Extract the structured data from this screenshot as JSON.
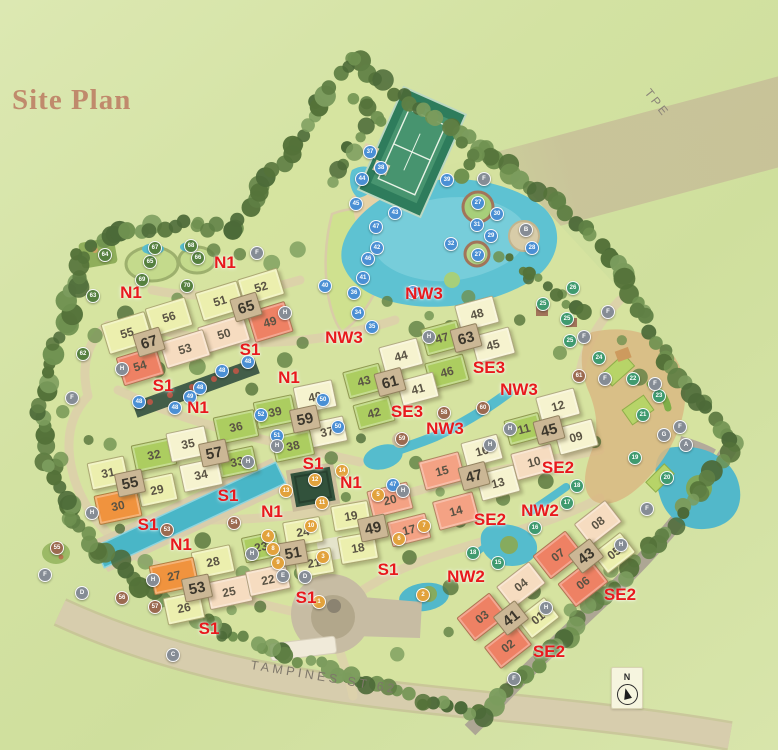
{
  "title": {
    "text": "Site Plan",
    "color": "#c08a6c"
  },
  "roads": {
    "tpe": "TPE",
    "tampines": "TAMPINES ST 62"
  },
  "compass": {
    "label": "N"
  },
  "colors": {
    "label_red": "#e8191d",
    "wing": {
      "lime": "#ecefae",
      "cream": "#f6f3cf",
      "green": "#accd60",
      "peach": "#f6dcc0",
      "salmon": "#f4a284",
      "coral": "#ee8164",
      "orange": "#f0933e"
    },
    "marker": {
      "b": "#4a8fd4",
      "g": "#3f9a6f",
      "o": "#e2a23c",
      "n": "#9b6a50",
      "f": "#55803f",
      "y": "#858c95"
    }
  },
  "unit_labels": [
    [
      "N1",
      131,
      293
    ],
    [
      "N1",
      225,
      263
    ],
    [
      "N1",
      198,
      408
    ],
    [
      "N1",
      289,
      378
    ],
    [
      "N1",
      351,
      483
    ],
    [
      "N1",
      272,
      512
    ],
    [
      "N1",
      181,
      545
    ],
    [
      "S1",
      250,
      350
    ],
    [
      "S1",
      163,
      386
    ],
    [
      "S1",
      228,
      496
    ],
    [
      "S1",
      148,
      525
    ],
    [
      "S1",
      313,
      464
    ],
    [
      "S1",
      388,
      570
    ],
    [
      "S1",
      306,
      598
    ],
    [
      "S1",
      209,
      629
    ],
    [
      "NW3",
      424,
      294
    ],
    [
      "NW3",
      344,
      338
    ],
    [
      "NW3",
      519,
      390
    ],
    [
      "NW3",
      445,
      429
    ],
    [
      "SE3",
      489,
      368
    ],
    [
      "SE3",
      407,
      412
    ],
    [
      "SE2",
      558,
      468
    ],
    [
      "SE2",
      490,
      520
    ],
    [
      "SE2",
      620,
      595
    ],
    [
      "SE2",
      549,
      652
    ],
    [
      "NW2",
      540,
      511
    ],
    [
      "NW2",
      466,
      577
    ]
  ],
  "towers": [
    [
      67,
      148,
      341,
      -17
    ],
    [
      65,
      245,
      306,
      -17
    ],
    [
      55,
      129,
      482,
      -12
    ],
    [
      57,
      213,
      452,
      -12
    ],
    [
      59,
      304,
      418,
      -12
    ],
    [
      61,
      389,
      381,
      -15
    ],
    [
      63,
      465,
      337,
      -15
    ],
    [
      45,
      548,
      429,
      -15
    ],
    [
      47,
      473,
      475,
      -15
    ],
    [
      49,
      372,
      527,
      -12
    ],
    [
      51,
      292,
      552,
      -10
    ],
    [
      53,
      196,
      587,
      -12
    ],
    [
      41,
      510,
      617,
      -38
    ],
    [
      43,
      585,
      555,
      -38
    ]
  ],
  "wings": [
    [
      "55",
      126,
      332,
      44,
      30,
      -17,
      "lime"
    ],
    [
      "56",
      168,
      316,
      40,
      28,
      -17,
      "lime"
    ],
    [
      "51",
      219,
      300,
      42,
      28,
      -17,
      "lime"
    ],
    [
      "52",
      260,
      286,
      40,
      26,
      -17,
      "lime"
    ],
    [
      "50",
      223,
      333,
      46,
      26,
      -17,
      "peach"
    ],
    [
      "53",
      184,
      348,
      44,
      26,
      -17,
      "peach"
    ],
    [
      "49",
      269,
      321,
      38,
      30,
      -17,
      "coral"
    ],
    [
      "54",
      139,
      365,
      40,
      28,
      -17,
      "coral"
    ],
    [
      "31",
      107,
      472,
      36,
      26,
      -12,
      "lime"
    ],
    [
      "32",
      153,
      454,
      40,
      26,
      -12,
      "green"
    ],
    [
      "35",
      187,
      443,
      38,
      28,
      -12,
      "cream"
    ],
    [
      "36",
      235,
      426,
      40,
      26,
      -12,
      "green"
    ],
    [
      "39",
      274,
      411,
      38,
      26,
      -12,
      "green"
    ],
    [
      "40",
      314,
      396,
      38,
      26,
      -12,
      "cream"
    ],
    [
      "37",
      326,
      431,
      36,
      24,
      -12,
      "cream"
    ],
    [
      "38",
      292,
      445,
      38,
      24,
      -12,
      "green"
    ],
    [
      "33",
      236,
      461,
      36,
      24,
      -12,
      "green"
    ],
    [
      "34",
      200,
      474,
      38,
      26,
      -12,
      "cream"
    ],
    [
      "29",
      156,
      489,
      36,
      26,
      -12,
      "lime"
    ],
    [
      "30",
      117,
      505,
      42,
      28,
      -12,
      "orange"
    ],
    [
      "28",
      212,
      561,
      38,
      26,
      -12,
      "lime"
    ],
    [
      "27",
      173,
      575,
      44,
      28,
      -12,
      "orange"
    ],
    [
      "26",
      183,
      607,
      36,
      26,
      -12,
      "lime"
    ],
    [
      "25",
      228,
      591,
      42,
      26,
      -12,
      "peach"
    ],
    [
      "22",
      267,
      579,
      40,
      24,
      -12,
      "peach"
    ],
    [
      "23",
      260,
      546,
      34,
      24,
      -12,
      "green"
    ],
    [
      "24",
      302,
      531,
      36,
      24,
      -10,
      "lime"
    ],
    [
      "21",
      313,
      562,
      36,
      24,
      -10,
      "lime"
    ],
    [
      "18",
      357,
      547,
      36,
      26,
      -10,
      "lime"
    ],
    [
      "19",
      350,
      515,
      36,
      24,
      -10,
      "lime"
    ],
    [
      "20",
      389,
      499,
      40,
      26,
      -14,
      "salmon"
    ],
    [
      "17",
      408,
      529,
      38,
      24,
      -14,
      "salmon"
    ],
    [
      "15",
      441,
      470,
      40,
      28,
      -15,
      "salmon"
    ],
    [
      "14",
      455,
      510,
      40,
      28,
      -15,
      "salmon"
    ],
    [
      "16",
      481,
      450,
      36,
      24,
      -15,
      "cream"
    ],
    [
      "13",
      497,
      482,
      38,
      26,
      -15,
      "cream"
    ],
    [
      "10",
      533,
      461,
      40,
      26,
      -15,
      "peach"
    ],
    [
      "11",
      523,
      428,
      34,
      24,
      -15,
      "green"
    ],
    [
      "12",
      557,
      405,
      38,
      26,
      -15,
      "cream"
    ],
    [
      "09",
      575,
      436,
      38,
      26,
      -15,
      "cream"
    ],
    [
      "44",
      400,
      355,
      38,
      26,
      -15,
      "cream"
    ],
    [
      "43",
      363,
      380,
      36,
      26,
      -15,
      "green"
    ],
    [
      "46",
      446,
      371,
      38,
      26,
      -15,
      "green"
    ],
    [
      "41",
      417,
      388,
      36,
      24,
      -15,
      "cream"
    ],
    [
      "42",
      373,
      412,
      36,
      24,
      -15,
      "green"
    ],
    [
      "45",
      492,
      344,
      38,
      26,
      -15,
      "cream"
    ],
    [
      "48",
      476,
      313,
      38,
      26,
      -15,
      "cream"
    ],
    [
      "47",
      441,
      337,
      36,
      26,
      -15,
      "green"
    ],
    [
      "08",
      597,
      522,
      38,
      26,
      -38,
      "peach"
    ],
    [
      "07",
      557,
      554,
      40,
      28,
      -38,
      "coral"
    ],
    [
      "06",
      582,
      582,
      40,
      28,
      -38,
      "coral"
    ],
    [
      "05",
      613,
      552,
      34,
      24,
      -38,
      "lime"
    ],
    [
      "04",
      520,
      584,
      40,
      26,
      -38,
      "peach"
    ],
    [
      "03",
      481,
      616,
      40,
      28,
      -38,
      "coral"
    ],
    [
      "02",
      507,
      645,
      38,
      26,
      -38,
      "coral"
    ],
    [
      "01",
      537,
      617,
      34,
      24,
      -38,
      "lime"
    ]
  ],
  "markers": [
    [
      "27",
      478,
      203,
      "b"
    ],
    [
      "30",
      497,
      214,
      "b"
    ],
    [
      "31",
      477,
      225,
      "b"
    ],
    [
      "29",
      491,
      236,
      "b"
    ],
    [
      "32",
      451,
      244,
      "b"
    ],
    [
      "27",
      478,
      255,
      "b"
    ],
    [
      "28",
      532,
      248,
      "b"
    ],
    [
      "33",
      413,
      292,
      "b"
    ],
    [
      "34",
      358,
      313,
      "b"
    ],
    [
      "35",
      372,
      327,
      "b"
    ],
    [
      "36",
      354,
      293,
      "b"
    ],
    [
      "37",
      370,
      152,
      "b"
    ],
    [
      "38",
      381,
      168,
      "b"
    ],
    [
      "39",
      447,
      180,
      "b"
    ],
    [
      "40",
      325,
      286,
      "b"
    ],
    [
      "41",
      363,
      278,
      "b"
    ],
    [
      "42",
      377,
      248,
      "b"
    ],
    [
      "43",
      395,
      213,
      "b"
    ],
    [
      "44",
      362,
      179,
      "b"
    ],
    [
      "45",
      356,
      204,
      "b"
    ],
    [
      "46",
      368,
      259,
      "b"
    ],
    [
      "47",
      376,
      227,
      "b"
    ],
    [
      "47",
      393,
      485,
      "b"
    ],
    [
      "48",
      139,
      402,
      "b"
    ],
    [
      "48",
      175,
      408,
      "b"
    ],
    [
      "48",
      200,
      388,
      "b"
    ],
    [
      "48",
      222,
      371,
      "b"
    ],
    [
      "48",
      248,
      362,
      "b"
    ],
    [
      "49",
      190,
      397,
      "b"
    ],
    [
      "50",
      323,
      400,
      "b"
    ],
    [
      "50",
      338,
      427,
      "b"
    ],
    [
      "51",
      277,
      436,
      "b"
    ],
    [
      "52",
      261,
      415,
      "b"
    ],
    [
      "15",
      498,
      563,
      "g"
    ],
    [
      "16",
      535,
      528,
      "g"
    ],
    [
      "17",
      567,
      503,
      "g"
    ],
    [
      "18",
      577,
      486,
      "g"
    ],
    [
      "18",
      473,
      553,
      "g"
    ],
    [
      "19",
      635,
      458,
      "g"
    ],
    [
      "20",
      667,
      478,
      "g"
    ],
    [
      "21",
      643,
      415,
      "g"
    ],
    [
      "22",
      633,
      379,
      "g"
    ],
    [
      "23",
      659,
      396,
      "g"
    ],
    [
      "24",
      599,
      358,
      "g"
    ],
    [
      "25",
      543,
      304,
      "g"
    ],
    [
      "25",
      567,
      319,
      "g"
    ],
    [
      "25",
      570,
      341,
      "g"
    ],
    [
      "26",
      573,
      288,
      "g"
    ],
    [
      "1",
      319,
      602,
      "o"
    ],
    [
      "2",
      423,
      595,
      "o"
    ],
    [
      "3",
      323,
      557,
      "o"
    ],
    [
      "4",
      268,
      536,
      "o"
    ],
    [
      "5",
      378,
      495,
      "o"
    ],
    [
      "6",
      399,
      539,
      "o"
    ],
    [
      "7",
      424,
      526,
      "o"
    ],
    [
      "8",
      273,
      549,
      "o"
    ],
    [
      "9",
      278,
      563,
      "o"
    ],
    [
      "10",
      311,
      526,
      "o"
    ],
    [
      "11",
      322,
      503,
      "o"
    ],
    [
      "12",
      315,
      480,
      "o"
    ],
    [
      "13",
      286,
      491,
      "o"
    ],
    [
      "14",
      342,
      471,
      "o"
    ],
    [
      "53",
      167,
      530,
      "n"
    ],
    [
      "54",
      234,
      523,
      "n"
    ],
    [
      "55",
      57,
      548,
      "n"
    ],
    [
      "56",
      122,
      598,
      "n"
    ],
    [
      "57",
      155,
      607,
      "n"
    ],
    [
      "58",
      444,
      413,
      "n"
    ],
    [
      "59",
      402,
      439,
      "n"
    ],
    [
      "60",
      483,
      408,
      "n"
    ],
    [
      "61",
      579,
      376,
      "n"
    ],
    [
      "62",
      83,
      354,
      "f"
    ],
    [
      "63",
      93,
      296,
      "f"
    ],
    [
      "64",
      105,
      255,
      "f"
    ],
    [
      "65",
      150,
      262,
      "f"
    ],
    [
      "66",
      198,
      258,
      "f"
    ],
    [
      "67",
      155,
      248,
      "f"
    ],
    [
      "68",
      191,
      246,
      "f"
    ],
    [
      "69",
      142,
      280,
      "f"
    ],
    [
      "70",
      187,
      286,
      "f"
    ],
    [
      "A",
      686,
      445,
      "y"
    ],
    [
      "B",
      526,
      230,
      "y"
    ],
    [
      "C",
      173,
      655,
      "y"
    ],
    [
      "D",
      305,
      577,
      "y"
    ],
    [
      "D",
      82,
      593,
      "y"
    ],
    [
      "E",
      283,
      576,
      "y"
    ],
    [
      "F",
      257,
      253,
      "y"
    ],
    [
      "F",
      484,
      179,
      "y"
    ],
    [
      "F",
      608,
      312,
      "y"
    ],
    [
      "F",
      584,
      337,
      "y"
    ],
    [
      "F",
      605,
      379,
      "y"
    ],
    [
      "F",
      655,
      384,
      "y"
    ],
    [
      "F",
      680,
      427,
      "y"
    ],
    [
      "F",
      72,
      398,
      "y"
    ],
    [
      "F",
      45,
      575,
      "y"
    ],
    [
      "F",
      647,
      509,
      "y"
    ],
    [
      "F",
      514,
      679,
      "y"
    ],
    [
      "G",
      664,
      435,
      "y"
    ],
    [
      "H",
      285,
      313,
      "y"
    ],
    [
      "H",
      122,
      369,
      "y"
    ],
    [
      "H",
      429,
      337,
      "y"
    ],
    [
      "H",
      248,
      462,
      "y"
    ],
    [
      "H",
      277,
      446,
      "y"
    ],
    [
      "H",
      510,
      429,
      "y"
    ],
    [
      "H",
      490,
      445,
      "y"
    ],
    [
      "H",
      403,
      491,
      "y"
    ],
    [
      "H",
      252,
      554,
      "y"
    ],
    [
      "H",
      153,
      580,
      "y"
    ],
    [
      "H",
      546,
      608,
      "y"
    ],
    [
      "H",
      621,
      545,
      "y"
    ],
    [
      "H",
      92,
      513,
      "y"
    ]
  ]
}
